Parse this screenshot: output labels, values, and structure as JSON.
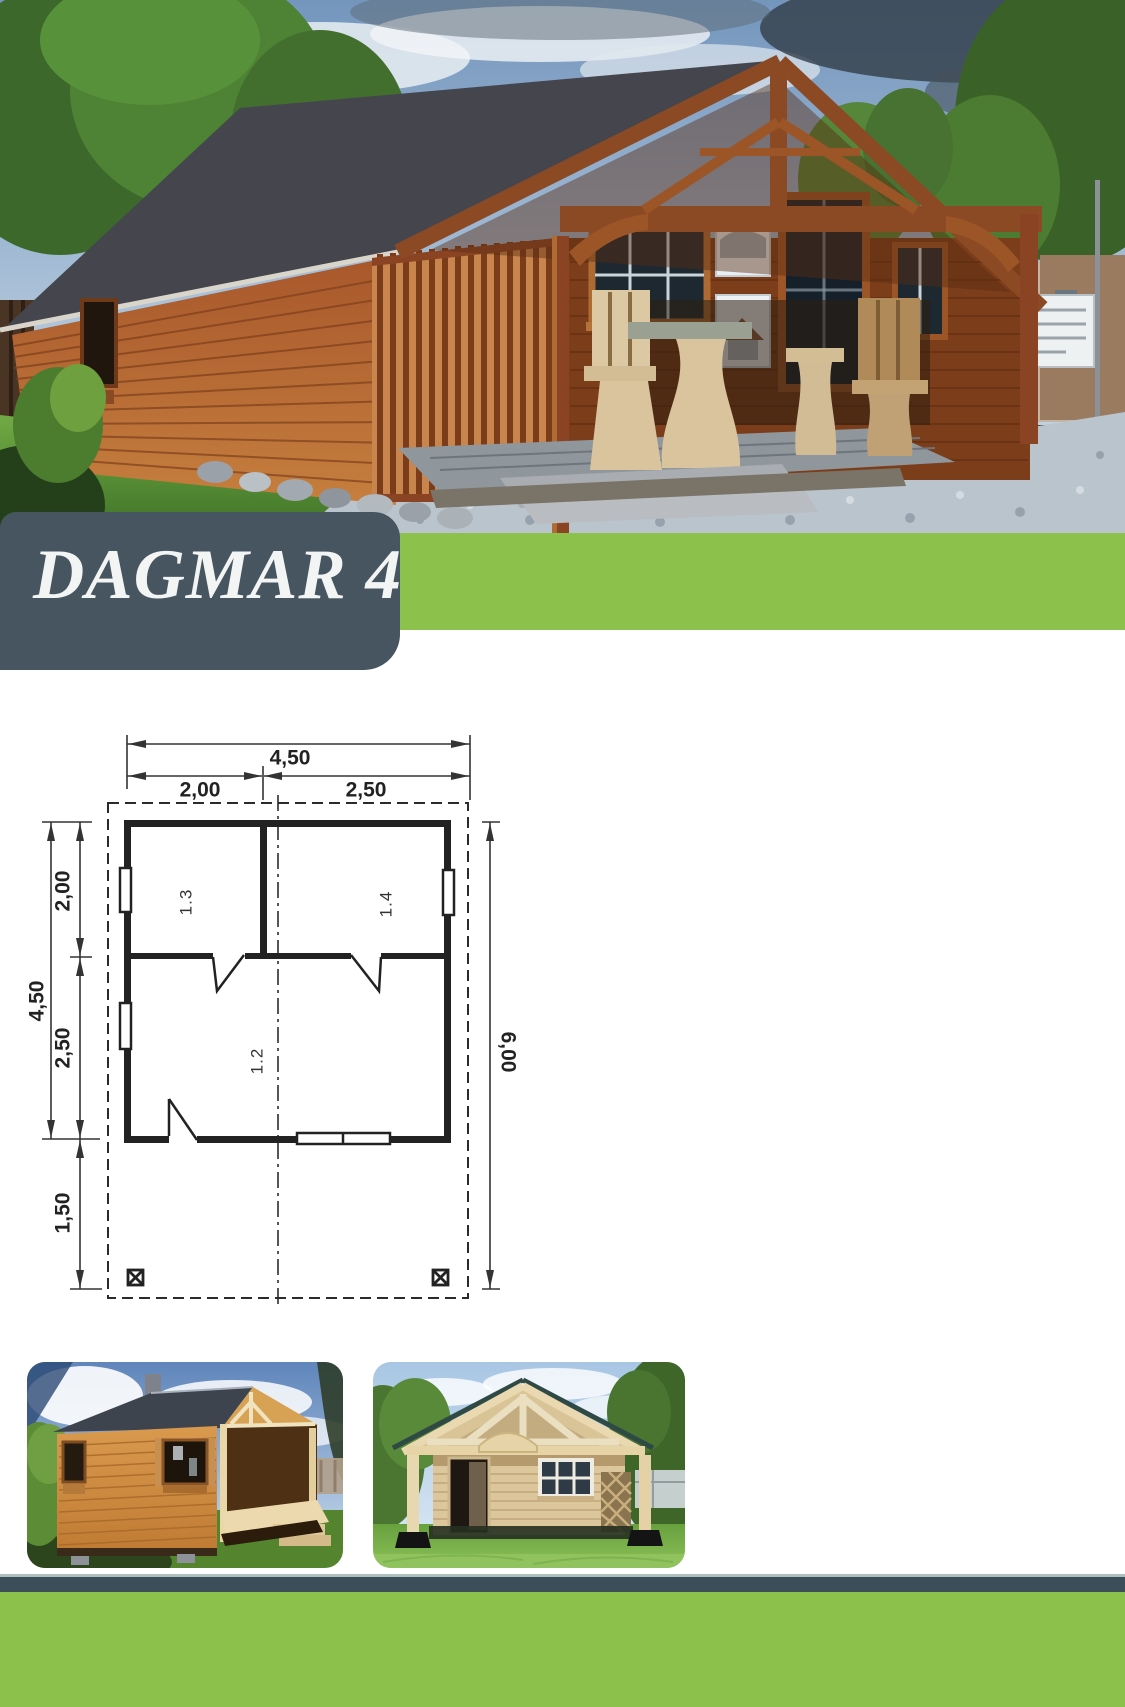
{
  "colors": {
    "accent-green": "#8cc24b",
    "slate": "#475560",
    "footer-dark": "#3c4e59",
    "plan-line": "#2b2b2b"
  },
  "banner": {
    "title": "DAGMAR 4"
  },
  "floor_plan": {
    "dims": {
      "top_total": "4,50",
      "top_left": "2,00",
      "top_right": "2,50",
      "left_total": "4,50",
      "left_top": "2,00",
      "left_middle": "2,50",
      "left_bottom": "1,50",
      "right_total": "6,00"
    },
    "rooms": {
      "main": "1.2",
      "left": "1.3",
      "right": "1.4"
    }
  }
}
